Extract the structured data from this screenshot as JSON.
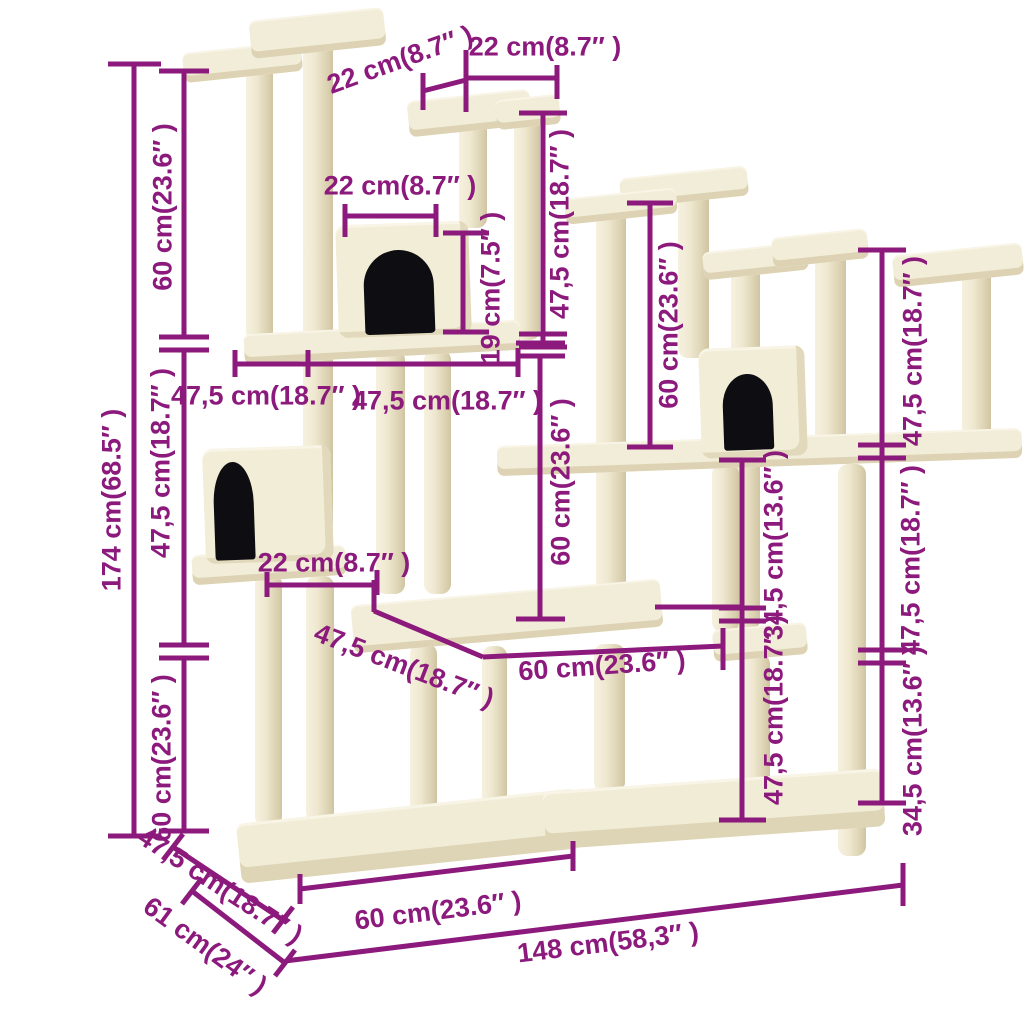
{
  "diagram": {
    "subject": "cat-tree-with-scratching-posts-dimension-diagram",
    "units": "cm-and-inches"
  },
  "colors": {
    "accent": "#8c1a7c",
    "wood": "#f2edd8",
    "wood_shadow": "#ddd3b4",
    "post_dark": "#cfc5a2",
    "opening": "#0e0e12",
    "background": "#ffffff"
  },
  "labels": [
    {
      "id": "top-left-22",
      "text": "22 cm(8.7″ )"
    },
    {
      "id": "top-right-22",
      "text": "22 cm(8.7″ )"
    },
    {
      "id": "upper-house-22",
      "text": "22 cm(8.7″ )"
    },
    {
      "id": "upper-house-19",
      "text": "19 cm(7.5″ )"
    },
    {
      "id": "center-top-47-5",
      "text": "47,5 cm(18.7″ )"
    },
    {
      "id": "left-top-60",
      "text": "60 cm(23.6″ )"
    },
    {
      "id": "total-height-174",
      "text": "174 cm(68.5″ )"
    },
    {
      "id": "left-mid-47-5",
      "text": "47,5 cm(18.7″ )"
    },
    {
      "id": "left-bottom-60",
      "text": "60 cm(23.6″ )"
    },
    {
      "id": "mid-width-47-5-a",
      "text": "47,5 cm(18.7″ )"
    },
    {
      "id": "mid-width-47-5-b",
      "text": "47,5 cm(18.7″ )"
    },
    {
      "id": "lower-house-22",
      "text": "22 cm(8.7″ )"
    },
    {
      "id": "base-depth-47-5",
      "text": "47,5 cm(18.7″ )"
    },
    {
      "id": "base-depth-61",
      "text": "61 cm(24″ )"
    },
    {
      "id": "mid-depth-47-5",
      "text": "47,5 cm(18.7″ )"
    },
    {
      "id": "mid-platform-60",
      "text": "60 cm(23.6″ )"
    },
    {
      "id": "center-60",
      "text": "60 cm(23.6″ )"
    },
    {
      "id": "right-top-60",
      "text": "60 cm(23.6″ )"
    },
    {
      "id": "right-top-47-5",
      "text": "47,5 cm(18.7″ )"
    },
    {
      "id": "inner-top-34-5",
      "text": "34,5 cm(13.6″ )"
    },
    {
      "id": "right-mid-47-5",
      "text": "47,5 cm(18.7″ )"
    },
    {
      "id": "inner-bottom-47-5",
      "text": "47,5 cm(18.7″ )"
    },
    {
      "id": "right-bottom-34-5",
      "text": "34,5 cm(13.6″ )"
    },
    {
      "id": "base-front-60",
      "text": "60 cm(23.6″ )"
    },
    {
      "id": "base-total-148",
      "text": "148 cm(58,3″ )"
    }
  ]
}
